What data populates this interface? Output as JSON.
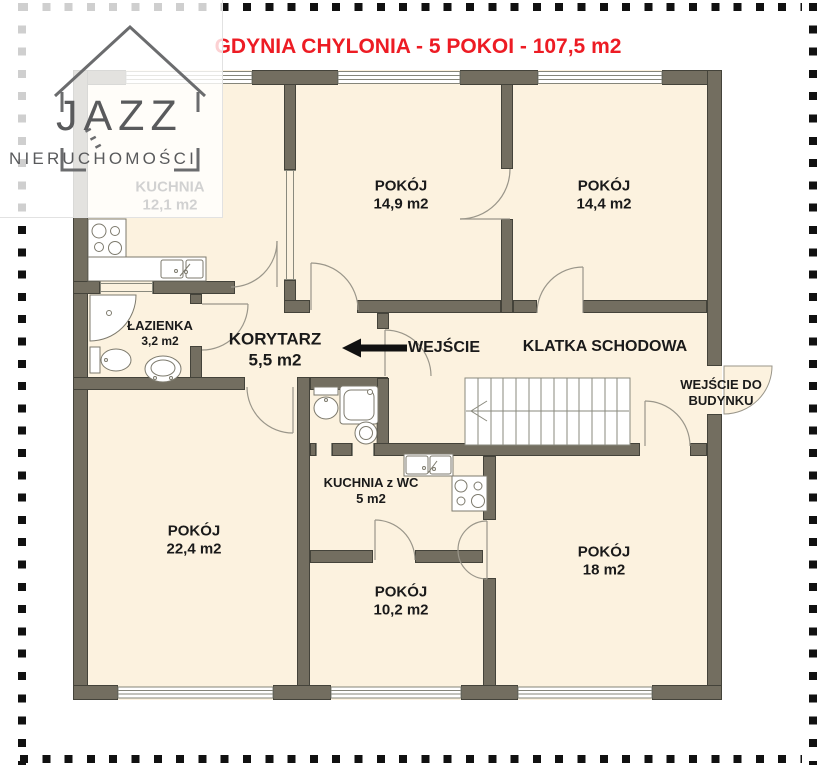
{
  "title": "GDYNIA CHYLONIA - 5 POKOI - 107,5 m2",
  "logo": {
    "brand": "JAZZ",
    "subtitle": "NIERUCHOMOŚCI"
  },
  "rooms": {
    "kuchnia": {
      "name": "KUCHNIA",
      "area": "12,1 m2"
    },
    "pokoj_14_9": {
      "name": "POKÓJ",
      "area": "14,9 m2"
    },
    "pokoj_14_4": {
      "name": "POKÓJ",
      "area": "14,4 m2"
    },
    "lazienka": {
      "name": "ŁAZIENKA",
      "area": "3,2 m2"
    },
    "korytarz": {
      "name": "KORYTARZ",
      "area": "5,5 m2"
    },
    "pokoj_22_4": {
      "name": "POKÓJ",
      "area": "22,4 m2"
    },
    "kuchnia_z_wc": {
      "name": "KUCHNIA z WC",
      "area": "5 m2"
    },
    "pokoj_10_2": {
      "name": "POKÓJ",
      "area": "10,2 m2"
    },
    "pokoj_18": {
      "name": "POKÓJ",
      "area": "18 m2"
    }
  },
  "annotations": {
    "entrance": "WEJŚCIE",
    "staircase": "KLATKA SCHODOWA",
    "building_entrance": [
      "WEJŚCIE DO",
      "BUDYNKU"
    ]
  },
  "colors": {
    "title_red": "#ed1c24",
    "wall": "#736e60",
    "floor": "#fcf2df",
    "logo_gray": "#595a5c"
  }
}
